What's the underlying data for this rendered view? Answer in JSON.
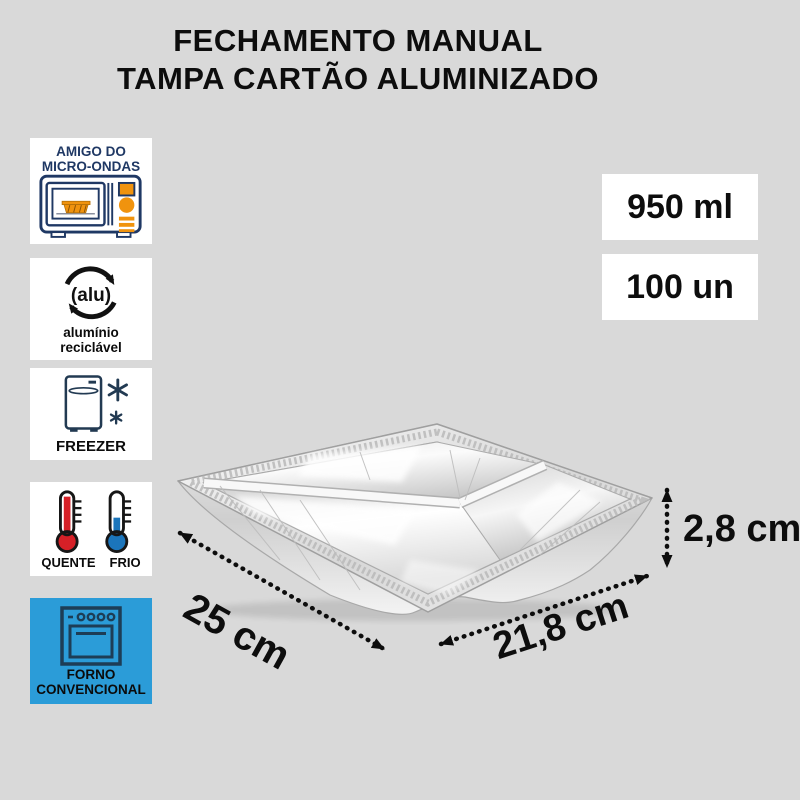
{
  "title": {
    "line1": "FECHAMENTO MANUAL",
    "line2": "TAMPA CARTÃO ALUMINIZADO"
  },
  "badges": {
    "microwave": {
      "icon": "microwave-icon",
      "line1": "AMIGO DO",
      "line2": "MICRO-ONDAS"
    },
    "alu": {
      "icon": "recycle-alu-icon",
      "symbol": "(alu)",
      "line1": "alumínio",
      "line2": "reciclável"
    },
    "freezer": {
      "icon": "freezer-icon",
      "label": "FREEZER"
    },
    "temperature": {
      "icon": "thermometers-icon",
      "hot": "QUENTE",
      "cold": "FRIO"
    },
    "oven": {
      "icon": "conventional-oven-icon",
      "line1": "FORNO",
      "line2": "CONVENCIONAL"
    }
  },
  "specs": [
    {
      "label": "950 ml"
    },
    {
      "label": "100 un"
    }
  ],
  "dimensions": {
    "width_label": "25 cm",
    "depth_label": "21,8 cm",
    "height_label": "2,8 cm"
  },
  "colors": {
    "background": "#d9d9d9",
    "navy": "#1f3864",
    "orange": "#f0930e",
    "oven_box_blue": "#2b9cd8",
    "hot_red": "#d62027",
    "cold_blue": "#1b75bb",
    "text": "#0d0d0d",
    "box_white": "#ffffff"
  }
}
